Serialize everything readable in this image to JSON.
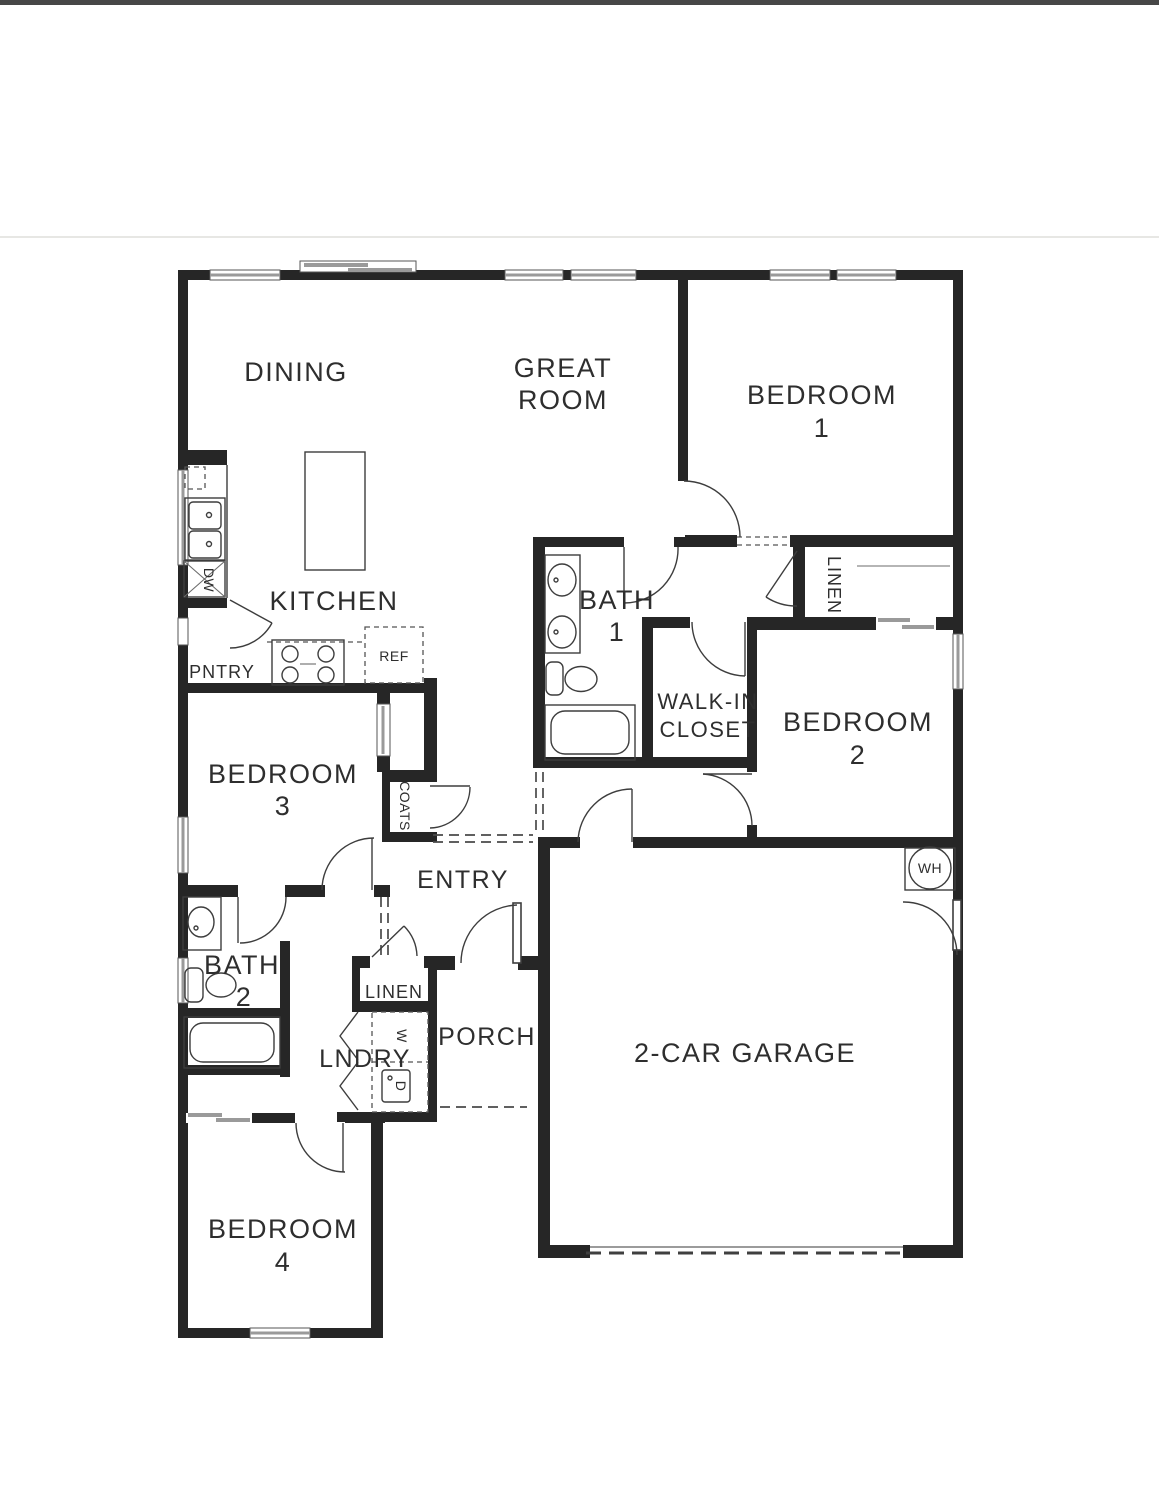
{
  "colors": {
    "wall": "#262626",
    "line": "#3d3d3d",
    "window": "#9a9a9a",
    "text": "#2e2e2e",
    "paper": "#ffffff"
  },
  "labels": {
    "dining": "DINING",
    "great_line1": "GREAT",
    "great_line2": "ROOM",
    "bedroom": "BEDROOM",
    "bed1_num": "1",
    "bed2_num": "2",
    "bed3_num": "3",
    "bed4_num": "4",
    "kitchen": "KITCHEN",
    "bath": "BATH",
    "bath1_num": "1",
    "bath2_num": "2",
    "walkin_line1": "WALK-IN",
    "walkin_line2": "CLOSET",
    "linen_upper": "LINEN",
    "linen_lower": "LINEN",
    "coats": "COATS",
    "pantry": "PNTRY",
    "fridge": "REF",
    "dishwasher": "DW",
    "entry": "ENTRY",
    "porch": "PORCH",
    "laundry": "LNDRY",
    "washer": "W",
    "dryer": "D",
    "garage": "2-CAR GARAGE",
    "water_heater": "WH"
  }
}
